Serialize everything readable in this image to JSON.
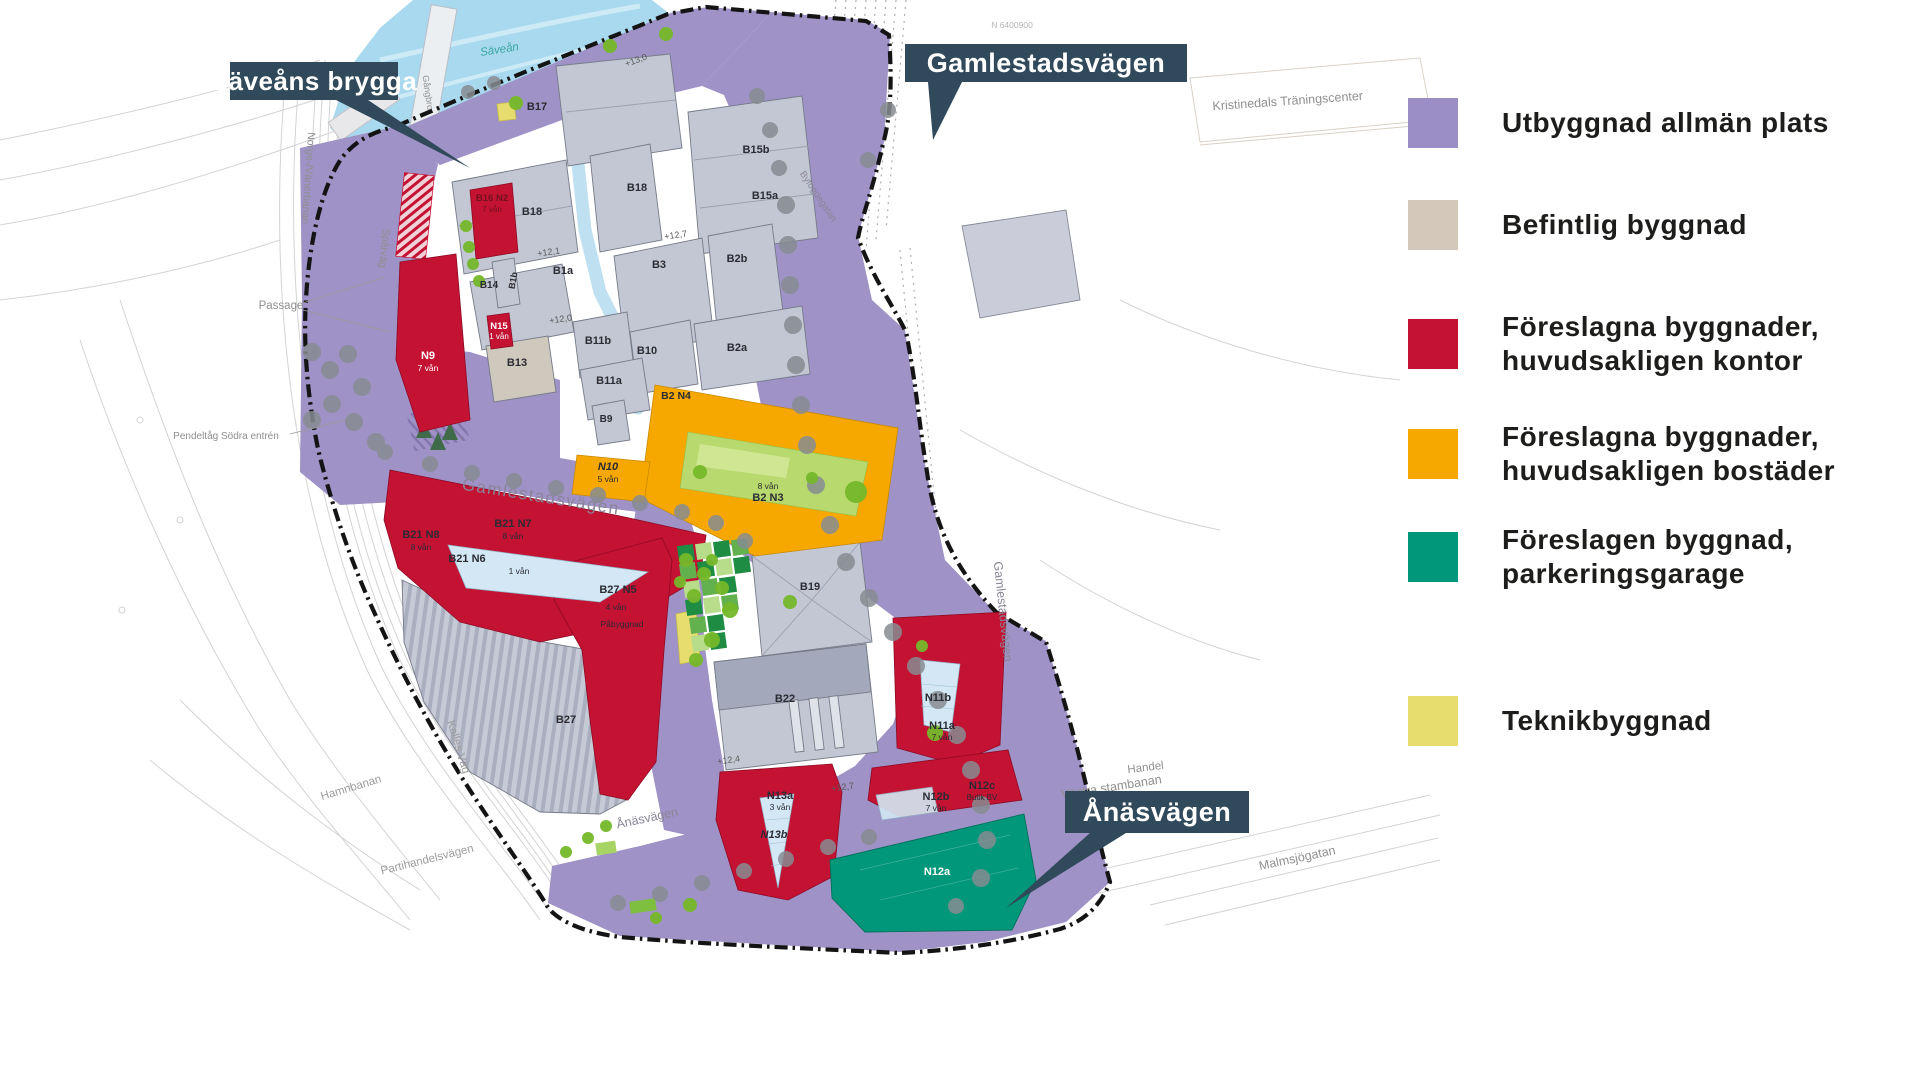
{
  "callouts": {
    "saveans": {
      "label": "Säveåns brygga"
    },
    "gamlestadsvagen": {
      "label": "Gamlestadsvägen"
    },
    "anasvagen": {
      "label": "Ånäsvägen"
    }
  },
  "colors": {
    "allman_plats": "#9b8dc5",
    "befintlig": "#d3c8b9",
    "kontor": "#c41233",
    "bostader": "#f6a800",
    "parkeringsgarage": "#00977b",
    "teknik": "#e7dd6e",
    "callout_bg": "#304a5b",
    "river": "#a9d9ef"
  },
  "legend": {
    "tops": [
      98,
      200,
      310,
      420,
      523,
      696
    ],
    "items": [
      {
        "name": "utbyggnad-allman-plats",
        "color": "#9b8dc5",
        "lines": [
          "Utbyggnad allmän plats"
        ]
      },
      {
        "name": "befintlig-byggnad",
        "color": "#d3c8b9",
        "lines": [
          "Befintlig byggnad"
        ]
      },
      {
        "name": "foreslagna-byggnader-kontor",
        "color": "#c41233",
        "lines": [
          "Föreslagna byggnader,",
          "huvudsakligen kontor"
        ]
      },
      {
        "name": "foreslagna-byggnader-bostader",
        "color": "#f6a800",
        "lines": [
          "Föreslagna byggnader,",
          "huvudsakligen bostäder"
        ]
      },
      {
        "name": "foreslagen-byggnad-parkeringsgarage",
        "color": "#00977b",
        "lines": [
          "Föreslagen byggnad,",
          "parkeringsgarage"
        ]
      },
      {
        "name": "teknikbyggnad",
        "color": "#e7dd6e",
        "lines": [
          "Teknikbyggnad"
        ]
      }
    ]
  },
  "map": {
    "labels": [
      {
        "t": "B17",
        "x": 537,
        "y": 110
      },
      {
        "t": "B15b",
        "x": 756,
        "y": 153
      },
      {
        "t": "B15a",
        "x": 765,
        "y": 199
      },
      {
        "t": "B18",
        "x": 532,
        "y": 215
      },
      {
        "t": "B18",
        "x": 637,
        "y": 191
      },
      {
        "t": "B1a",
        "x": 563,
        "y": 274
      },
      {
        "t": "B1b",
        "x": 516,
        "y": 281,
        "r": -80,
        "s": 9
      },
      {
        "t": "B14",
        "x": 489,
        "y": 288,
        "s": 10
      },
      {
        "t": "B3",
        "x": 659,
        "y": 268
      },
      {
        "t": "B2b",
        "x": 737,
        "y": 262
      },
      {
        "t": "B2a",
        "x": 737,
        "y": 351
      },
      {
        "t": "B10",
        "x": 647,
        "y": 354
      },
      {
        "t": "B11b",
        "x": 598,
        "y": 344
      },
      {
        "t": "B11a",
        "x": 609,
        "y": 384
      },
      {
        "t": "B13",
        "x": 517,
        "y": 366
      },
      {
        "t": "B9",
        "x": 606,
        "y": 422,
        "s": 10
      },
      {
        "t": "B16 N2",
        "x": 492,
        "y": 201,
        "s": 9.5,
        "c": "#70121f"
      },
      {
        "t": "7 vån",
        "x": 492,
        "y": 212,
        "s": 8,
        "w": 400,
        "c": "#70121f"
      },
      {
        "t": "N9",
        "x": 428,
        "y": 359,
        "c": "#ffffff"
      },
      {
        "t": "7 vån",
        "x": 428,
        "y": 371,
        "s": 8.5,
        "w": 400,
        "c": "#ffffff"
      },
      {
        "t": "N15",
        "x": 499,
        "y": 329,
        "s": 9.5,
        "c": "#ffffff"
      },
      {
        "t": "1 vån",
        "x": 499,
        "y": 339,
        "s": 8,
        "w": 400,
        "c": "#ffffff"
      },
      {
        "t": "N10",
        "x": 608,
        "y": 470,
        "i": 1
      },
      {
        "t": "5 vån",
        "x": 608,
        "y": 482,
        "s": 8.5,
        "w": 400
      },
      {
        "t": "B2 N4",
        "x": 676,
        "y": 399,
        "s": 10.5
      },
      {
        "t": "8 vån",
        "x": 768,
        "y": 489,
        "s": 8.5,
        "w": 400
      },
      {
        "t": "B2 N3",
        "x": 768,
        "y": 501
      },
      {
        "t": "B21 N8",
        "x": 421,
        "y": 538
      },
      {
        "t": "8 vån",
        "x": 421,
        "y": 550,
        "s": 8.5,
        "w": 400
      },
      {
        "t": "B21 N7",
        "x": 513,
        "y": 527
      },
      {
        "t": "8 vån",
        "x": 513,
        "y": 539,
        "s": 8.5,
        "w": 400
      },
      {
        "t": "B21 N6",
        "x": 467,
        "y": 562
      },
      {
        "t": "1 vån",
        "x": 519,
        "y": 574,
        "s": 8.5,
        "w": 400
      },
      {
        "t": "B27 N5",
        "x": 618,
        "y": 593
      },
      {
        "t": "4 vån",
        "x": 616,
        "y": 610,
        "s": 8.5,
        "w": 400
      },
      {
        "t": "Påbyggnad",
        "x": 622,
        "y": 627,
        "s": 8.5,
        "w": 400
      },
      {
        "t": "B27",
        "x": 566,
        "y": 723
      },
      {
        "t": "B19",
        "x": 810,
        "y": 590
      },
      {
        "t": "B22",
        "x": 785,
        "y": 702
      },
      {
        "t": "N13a",
        "x": 780,
        "y": 799
      },
      {
        "t": "3 vån",
        "x": 780,
        "y": 810,
        "s": 8.5,
        "w": 400
      },
      {
        "t": "N13b",
        "x": 774,
        "y": 838,
        "i": 1
      },
      {
        "t": "N11b",
        "x": 938,
        "y": 701
      },
      {
        "t": "N11a",
        "x": 942,
        "y": 729
      },
      {
        "t": "7 vån",
        "x": 942,
        "y": 740,
        "s": 8.5,
        "w": 400
      },
      {
        "t": "N12b",
        "x": 936,
        "y": 800
      },
      {
        "t": "7 vån",
        "x": 936,
        "y": 811,
        "s": 8.5,
        "w": 400
      },
      {
        "t": "N12c",
        "x": 982,
        "y": 789
      },
      {
        "t": "Butik BV",
        "x": 982,
        "y": 800,
        "s": 8,
        "w": 400
      },
      {
        "t": "N12a",
        "x": 937,
        "y": 875,
        "c": "#ffffff"
      },
      {
        "t": "Gamlestadsvägen",
        "x": 540,
        "y": 502,
        "r": 9,
        "s": 17,
        "c": "#8a8598",
        "w": 400,
        "ls": 1.5
      },
      {
        "t": "Gamlestadsvägen",
        "x": 999,
        "y": 612,
        "r": 84,
        "s": 12.5,
        "c": "#8a8598",
        "w": 400
      },
      {
        "t": "Ånäsvägen",
        "x": 648,
        "y": 822,
        "r": -12,
        "s": 12.5,
        "c": "#8a8598",
        "w": 400
      },
      {
        "t": "Kalles Väg",
        "x": 455,
        "y": 748,
        "r": 73,
        "s": 11.5,
        "c": "#9c9c9c",
        "w": 400
      },
      {
        "t": "Säveån",
        "x": 500,
        "y": 53,
        "r": -9,
        "s": 11.5,
        "c": "#3aa6a0",
        "w": 400,
        "i": 1
      },
      {
        "t": "Gångbro",
        "x": 425,
        "y": 93,
        "r": 82,
        "s": 9,
        "c": "#8f8f8f",
        "w": 400
      },
      {
        "t": "Spårväg",
        "x": 381,
        "y": 248,
        "r": 96,
        "s": 10.5,
        "c": "#8f8f8f",
        "w": 400
      },
      {
        "t": "Norge-/Vänerbanan",
        "x": 305,
        "y": 178,
        "r": 94,
        "s": 10.5,
        "c": "#8f8f8f",
        "w": 400
      },
      {
        "t": "Hamnbanan",
        "x": 352,
        "y": 791,
        "r": -17,
        "s": 11.5,
        "c": "#9c9c9c",
        "w": 400
      },
      {
        "t": "Partihandelsvägen",
        "x": 428,
        "y": 863,
        "r": -14,
        "s": 11.5,
        "c": "#9c9c9c",
        "w": 400
      },
      {
        "t": "Västra stambanan",
        "x": 1112,
        "y": 791,
        "r": -9,
        "s": 12.5,
        "c": "#8f8f8f",
        "w": 400
      },
      {
        "t": "Malmsjögatan",
        "x": 1298,
        "y": 862,
        "r": -12,
        "s": 12.5,
        "c": "#8f8f8f",
        "w": 400
      },
      {
        "t": "E 20",
        "x": 1100,
        "y": 833,
        "s": 12.5,
        "c": "#8f8f8f",
        "w": 400
      },
      {
        "t": "Handel",
        "x": 1146,
        "y": 771,
        "r": -7,
        "s": 11.5,
        "c": "#8f8f8f",
        "w": 400
      },
      {
        "t": "Kristinedals Träningscenter",
        "x": 1288,
        "y": 105,
        "r": -4,
        "s": 12.5,
        "c": "#8f8f8f",
        "w": 400
      },
      {
        "t": "N 6400900",
        "x": 1012,
        "y": 28,
        "s": 8.5,
        "c": "#b5b5b5",
        "w": 400
      },
      {
        "t": "Byfogdegatan",
        "x": 816,
        "y": 198,
        "r": 56,
        "s": 9.5,
        "c": "#8a8598",
        "w": 400
      },
      {
        "t": "Passage",
        "x": 281,
        "y": 309,
        "s": 11.5,
        "c": "#8f8f8f",
        "w": 400
      },
      {
        "t": "Pendeltåg Södra entrén",
        "x": 226,
        "y": 439,
        "s": 10,
        "c": "#8f8f8f",
        "w": 400
      },
      {
        "t": "+13,0",
        "x": 637,
        "y": 63,
        "r": -20,
        "s": 9,
        "c": "#5a5a5a",
        "w": 400
      },
      {
        "t": "+12,7",
        "x": 676,
        "y": 238,
        "r": -8,
        "s": 9,
        "c": "#5a5a5a",
        "w": 400
      },
      {
        "t": "+12,1",
        "x": 549,
        "y": 255,
        "r": -8,
        "s": 9,
        "c": "#5a5a5a",
        "w": 400
      },
      {
        "t": "+12,0",
        "x": 561,
        "y": 322,
        "r": -8,
        "s": 9,
        "c": "#5a5a5a",
        "w": 400
      },
      {
        "t": "+12,4",
        "x": 729,
        "y": 763,
        "r": -8,
        "s": 9,
        "c": "#5a5a5a",
        "w": 400
      },
      {
        "t": "+12,7",
        "x": 843,
        "y": 790,
        "r": -8,
        "s": 9,
        "c": "#5a5a5a",
        "w": 400
      }
    ],
    "trees_gray": [
      [
        757,
        96,
        8
      ],
      [
        770,
        130,
        8
      ],
      [
        779,
        168,
        8
      ],
      [
        786,
        205,
        9
      ],
      [
        788,
        245,
        9
      ],
      [
        790,
        285,
        9
      ],
      [
        793,
        325,
        9
      ],
      [
        796,
        365,
        9
      ],
      [
        801,
        405,
        9
      ],
      [
        807,
        445,
        9
      ],
      [
        816,
        485,
        9
      ],
      [
        830,
        525,
        9
      ],
      [
        846,
        562,
        9
      ],
      [
        869,
        598,
        9
      ],
      [
        893,
        632,
        9
      ],
      [
        916,
        666,
        9
      ],
      [
        938,
        700,
        9
      ],
      [
        957,
        735,
        9
      ],
      [
        971,
        770,
        9
      ],
      [
        981,
        805,
        9
      ],
      [
        987,
        840,
        9
      ],
      [
        981,
        878,
        9
      ],
      [
        956,
        906,
        8
      ],
      [
        618,
        903,
        8
      ],
      [
        660,
        894,
        8
      ],
      [
        702,
        883,
        8
      ],
      [
        744,
        871,
        8
      ],
      [
        786,
        859,
        8
      ],
      [
        828,
        847,
        8
      ],
      [
        869,
        837,
        8
      ],
      [
        385,
        452,
        8
      ],
      [
        430,
        464,
        8
      ],
      [
        472,
        473,
        8
      ],
      [
        514,
        481,
        8
      ],
      [
        556,
        488,
        8
      ],
      [
        598,
        495,
        8
      ],
      [
        640,
        503,
        8
      ],
      [
        682,
        512,
        8
      ],
      [
        716,
        523,
        8
      ],
      [
        745,
        541,
        8
      ],
      [
        312,
        352,
        9
      ],
      [
        330,
        370,
        9
      ],
      [
        348,
        354,
        9
      ],
      [
        362,
        387,
        9
      ],
      [
        332,
        404,
        9
      ],
      [
        354,
        422,
        9
      ],
      [
        312,
        420,
        9
      ],
      [
        376,
        442,
        9
      ],
      [
        468,
        92,
        7
      ],
      [
        494,
        83,
        7
      ],
      [
        888,
        110,
        8
      ],
      [
        868,
        160,
        8
      ]
    ],
    "trees_green": [
      [
        516,
        103,
        7
      ],
      [
        610,
        46,
        7
      ],
      [
        666,
        34,
        7
      ],
      [
        466,
        226,
        6
      ],
      [
        469,
        247,
        6
      ],
      [
        473,
        264,
        6
      ],
      [
        479,
        281,
        6
      ],
      [
        686,
        560,
        7
      ],
      [
        704,
        574,
        7
      ],
      [
        722,
        588,
        7
      ],
      [
        694,
        596,
        7
      ],
      [
        680,
        582,
        6
      ],
      [
        712,
        560,
        6
      ],
      [
        730,
        610,
        8
      ],
      [
        712,
        640,
        8
      ],
      [
        696,
        660,
        7
      ],
      [
        856,
        492,
        11
      ],
      [
        700,
        472,
        7
      ],
      [
        812,
        478,
        6
      ],
      [
        790,
        602,
        7
      ],
      [
        935,
        733,
        8
      ],
      [
        690,
        905,
        7
      ],
      [
        656,
        918,
        6
      ],
      [
        588,
        838,
        6
      ],
      [
        566,
        852,
        6
      ],
      [
        606,
        826,
        6
      ],
      [
        922,
        646,
        6
      ]
    ],
    "park_squares": [
      [
        678,
        545,
        "d"
      ],
      [
        696,
        543,
        "l"
      ],
      [
        714,
        541,
        "d"
      ],
      [
        732,
        539,
        "m"
      ],
      [
        680,
        563,
        "m"
      ],
      [
        698,
        561,
        "d"
      ],
      [
        716,
        559,
        "l"
      ],
      [
        734,
        557,
        "d"
      ],
      [
        684,
        581,
        "l"
      ],
      [
        702,
        579,
        "m"
      ],
      [
        720,
        577,
        "d"
      ],
      [
        686,
        599,
        "d"
      ],
      [
        704,
        597,
        "l"
      ],
      [
        722,
        595,
        "m"
      ],
      [
        690,
        617,
        "m"
      ],
      [
        708,
        615,
        "d"
      ],
      [
        692,
        635,
        "l"
      ],
      [
        710,
        633,
        "d"
      ]
    ]
  }
}
